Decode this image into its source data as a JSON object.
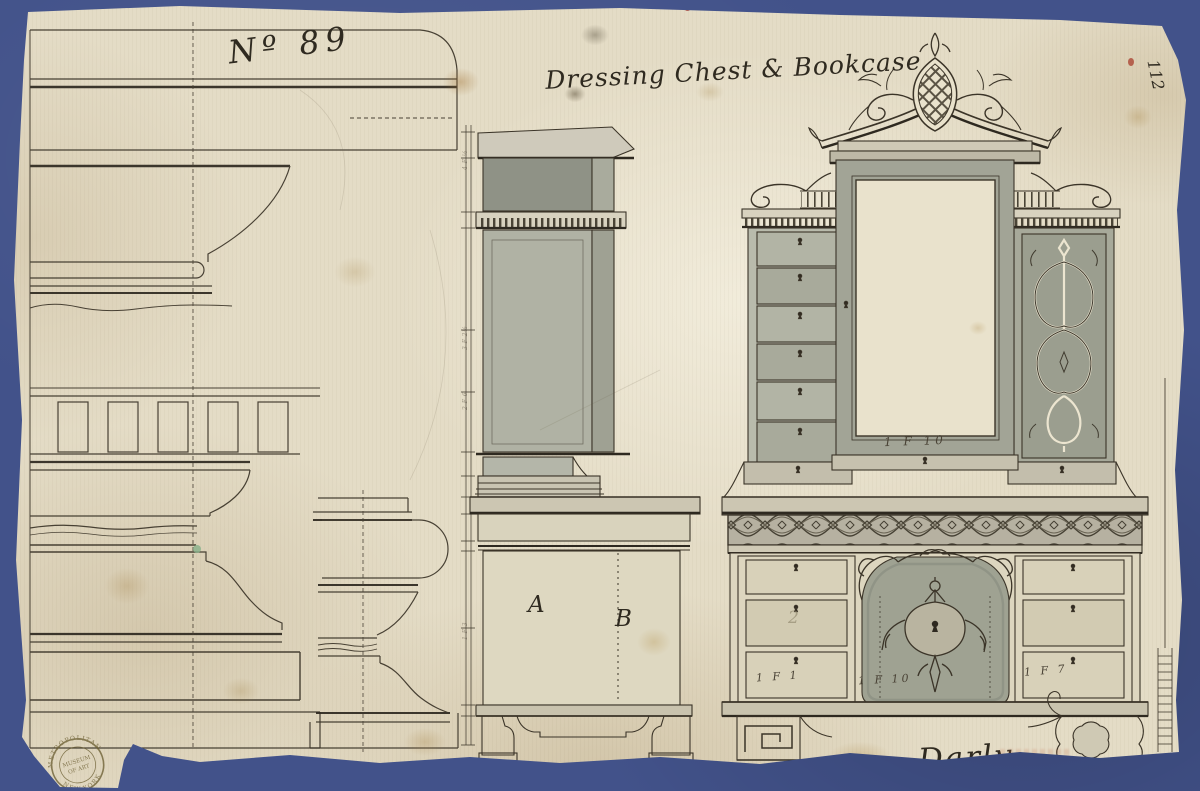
{
  "artwork": {
    "inscriptions": {
      "number": "Nº 89",
      "title": "Dressing Chest & Bookcase",
      "signature": "Darly",
      "corner_number": "112",
      "letter_a": "A",
      "letter_b": "B",
      "pencil_number": "2"
    },
    "dimension_notes": {
      "under_mirror": "1 F 10",
      "base_left": "1 F 1",
      "base_center": "1 F 10",
      "base_right": "1 F 7"
    },
    "scale_marks": [
      "3 F 2½",
      "2 F 6",
      "1 F 3",
      "4 F ½"
    ],
    "stamp": {
      "arc_top": "METROPOLITAN",
      "center_line1": "MUSEUM",
      "center_line2": "OF ART",
      "arc_bottom": "NEW-YORK"
    },
    "colors": {
      "background": "#42528a",
      "paper": "#e4dcc6",
      "wash_dark": "#8f9286",
      "wash_mid": "#abad9f",
      "ink": "#35302b",
      "stamp": "#6d6034"
    }
  }
}
